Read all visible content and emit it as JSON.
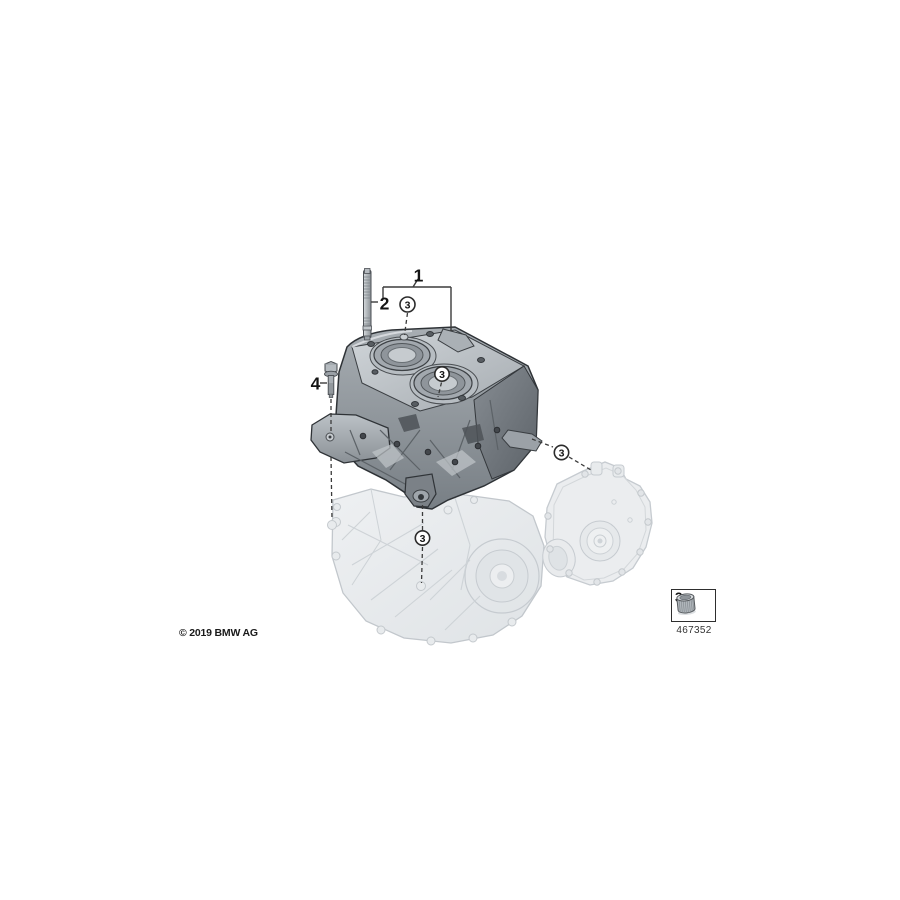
{
  "diagram": {
    "description": "Engine block parts exploded diagram",
    "callouts": {
      "item1": {
        "label": "1"
      },
      "item2": {
        "label": "2"
      },
      "item3": {
        "label": "3"
      },
      "item4": {
        "label": "4"
      }
    }
  },
  "part_box": {
    "callout_label": "3",
    "part_number": "467352"
  },
  "footer": {
    "copyright": "© 2019 BMW AG"
  },
  "colors": {
    "background": "#ffffff",
    "diagram_line": "#3b3b3b",
    "part_dark_gray": "#8d949a",
    "ghost_light_gray": "#e9ebed"
  }
}
